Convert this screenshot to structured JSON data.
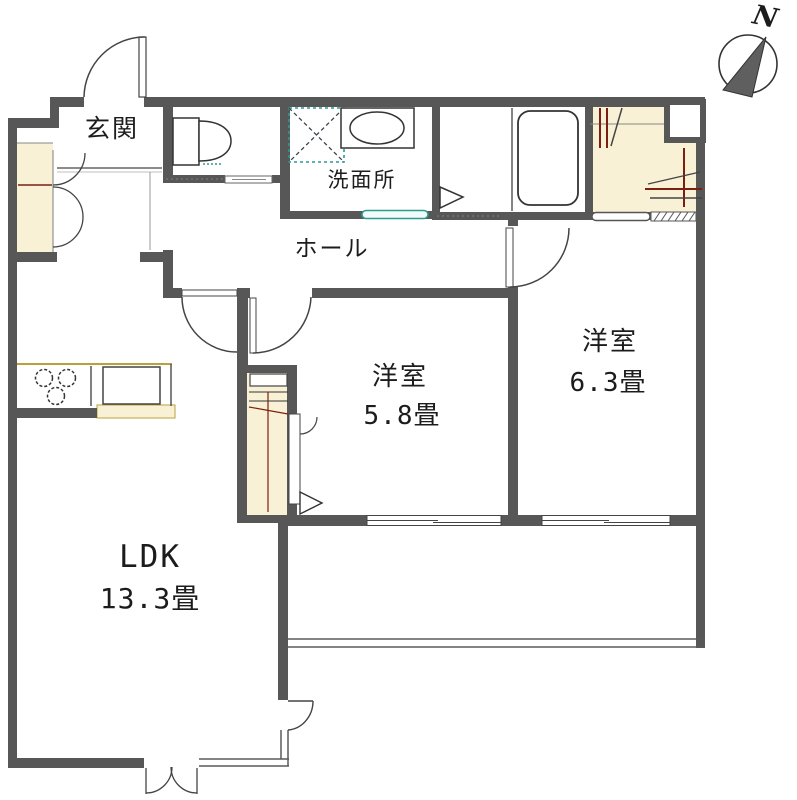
{
  "compass": {
    "label": "N"
  },
  "rooms": {
    "genkan": {
      "label": "玄関"
    },
    "hall": {
      "label": "ホール"
    },
    "washroom": {
      "label": "洗面所"
    },
    "bedroom_small": {
      "label": "洋室",
      "size": "5.8畳"
    },
    "bedroom_large": {
      "label": "洋室",
      "size": "6.3畳"
    },
    "ldk": {
      "label": "LDK",
      "size": "13.3畳"
    }
  },
  "colors": {
    "wall": "#575757",
    "line": "#444444",
    "thin": "#5a5a5a",
    "cream": "#f9f1d5",
    "olive": "#b9a23a",
    "teal": "#2e9a92",
    "red": "#7b2010",
    "needle": "#5f5f5f"
  }
}
